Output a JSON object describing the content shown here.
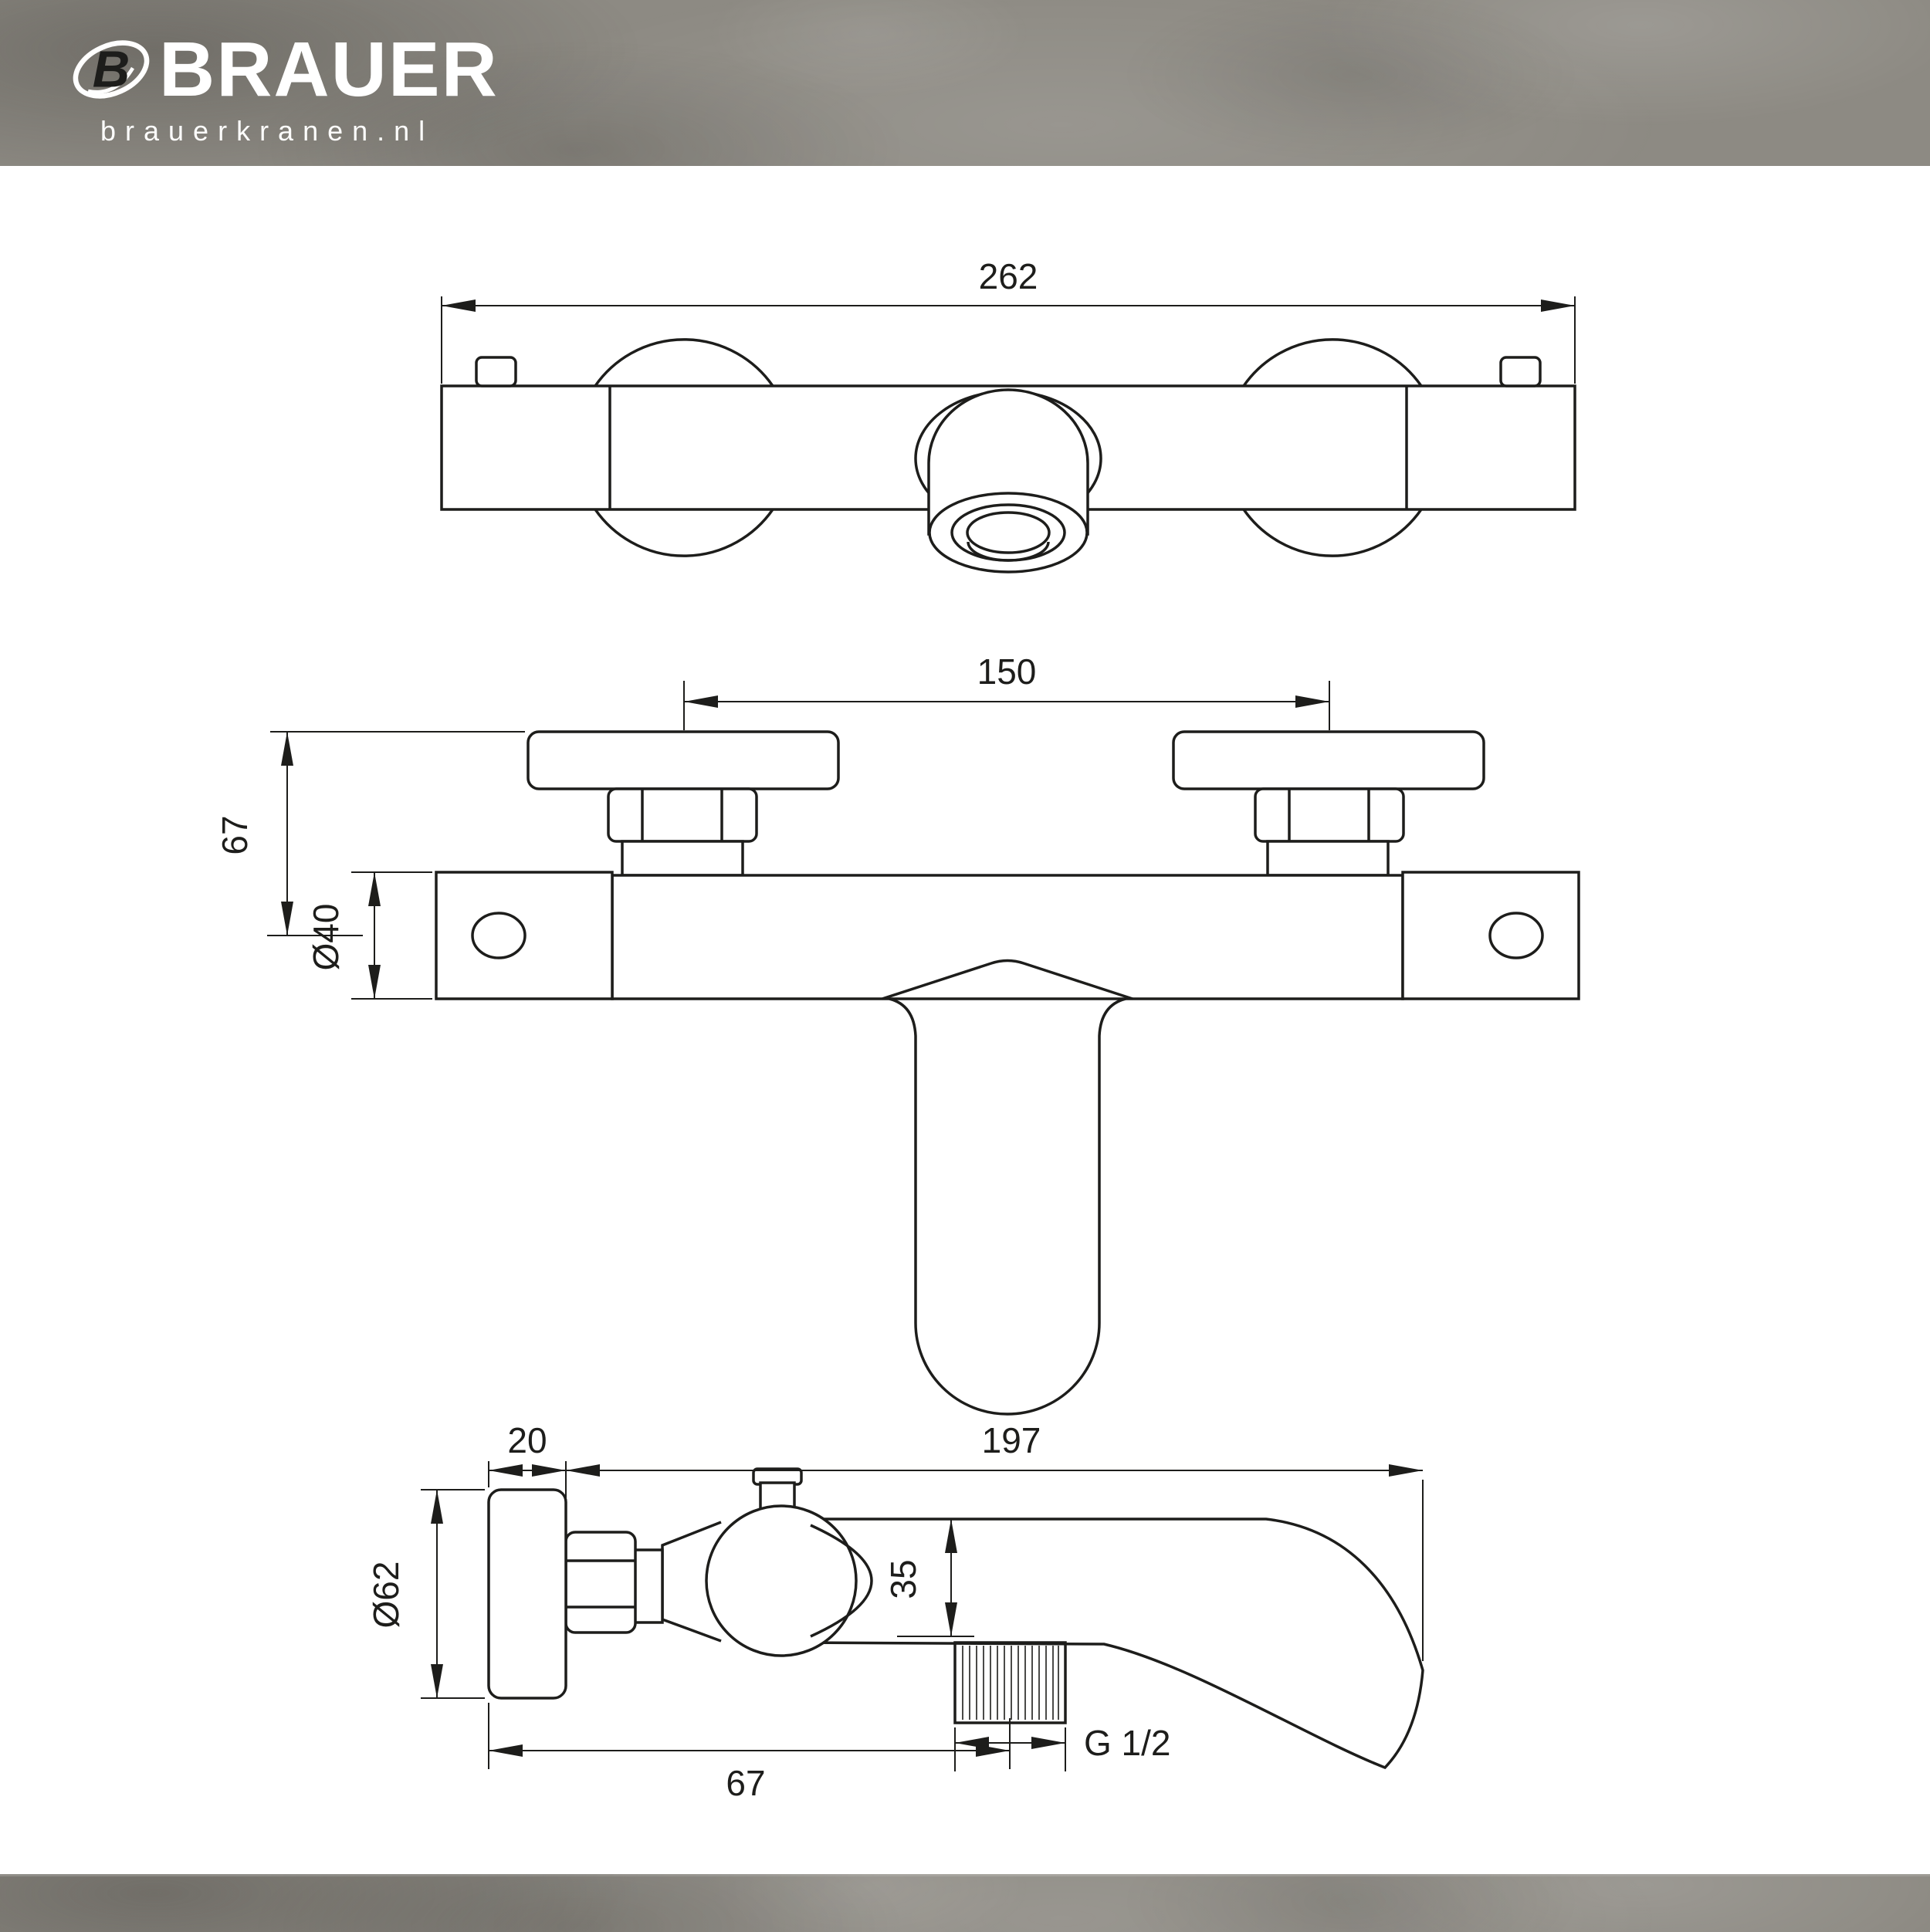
{
  "brand": {
    "name": "BRAUER",
    "website": "brauerkranen.nl"
  },
  "colors": {
    "band_background": "#8d8a83",
    "canvas": "#ffffff",
    "line": "#1d1d1b",
    "logo_text": "#ffffff"
  },
  "drawing": {
    "kind": "technical dimension drawing",
    "subject": "wall-mounted bath mixer tap, three orthographic views"
  },
  "dims": {
    "overall_width": "262",
    "connection_spacing": "150",
    "plate_to_body_center": "67",
    "handle_diameter": "Ø40",
    "plate_thickness": "20",
    "spout_length": "197",
    "plate_diameter": "Ø62",
    "body_top_to_outlet": "35",
    "outlet_thread": "G 1/2",
    "wall_to_outlet_center": "67"
  }
}
